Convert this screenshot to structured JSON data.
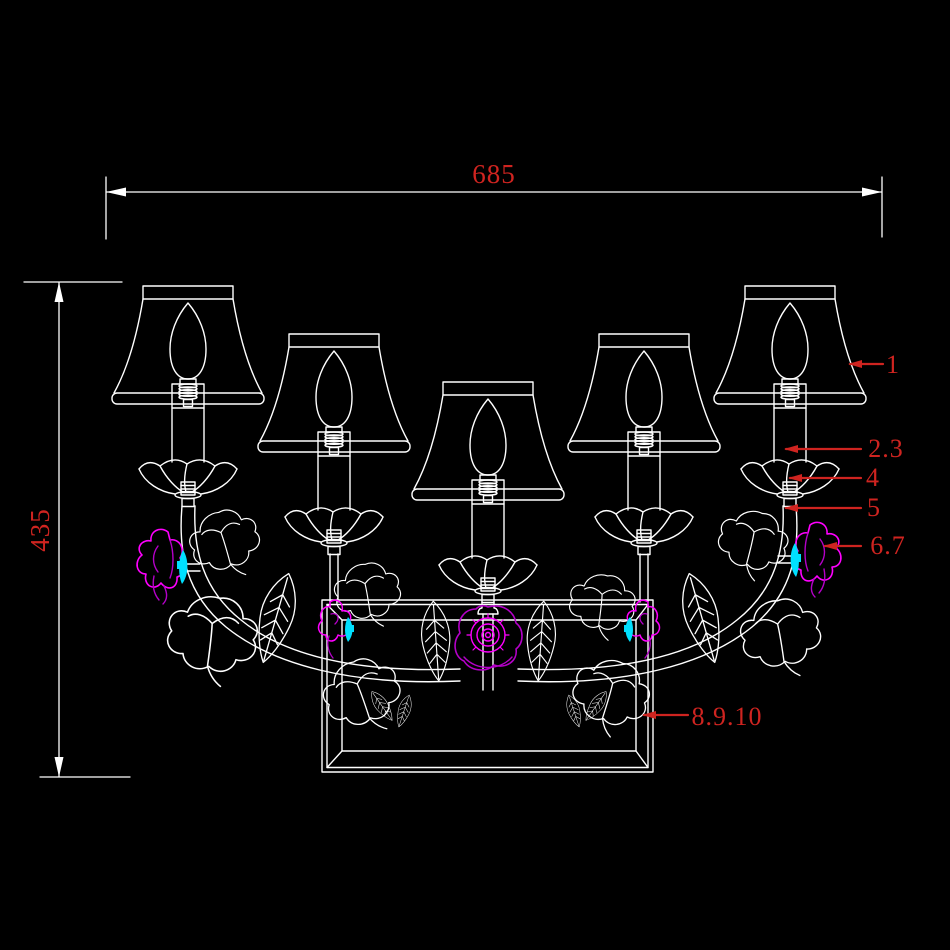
{
  "canvas": {
    "background": "#000000"
  },
  "colors": {
    "line": "#FFFFFF",
    "annotation_red": "#CF2420",
    "flower_magenta": "#FF00FF",
    "flower_violet": "#B400C8",
    "flower_cyan": "#00E0FF"
  },
  "dimensions": {
    "width_label": "685",
    "height_label": "435"
  },
  "callouts": [
    {
      "label": "1"
    },
    {
      "label": "2.3"
    },
    {
      "label": "4"
    },
    {
      "label": "5"
    },
    {
      "label": "6.7"
    },
    {
      "label": "8.9.10"
    }
  ]
}
